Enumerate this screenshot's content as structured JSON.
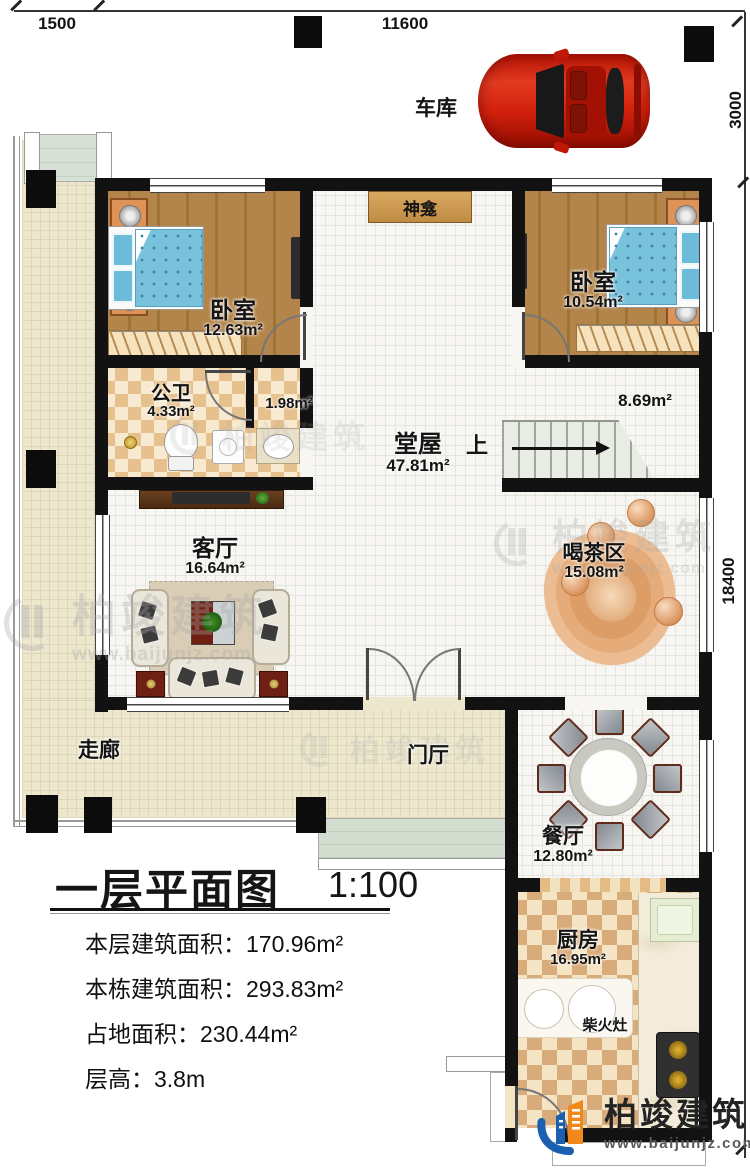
{
  "dimensions": {
    "left_top": "1500",
    "top": "11600",
    "right_upper": "3000",
    "right_side": "18400"
  },
  "rooms": {
    "garage": {
      "label": "车库"
    },
    "shrine": {
      "label": "神龛"
    },
    "bedroom_left": {
      "label": "卧室",
      "area": "12.63m²"
    },
    "bedroom_right": {
      "label": "卧室",
      "area": "10.54m²"
    },
    "bathroom": {
      "label": "公卫",
      "area": "4.33m²"
    },
    "washroom": {
      "area": "1.98m²"
    },
    "hall": {
      "label": "堂屋",
      "area": "47.81m²"
    },
    "stairs": {
      "up": "上",
      "area": "8.69m²"
    },
    "living": {
      "label": "客厅",
      "area": "16.64m²"
    },
    "tea": {
      "label": "喝茶区",
      "area": "15.08m²"
    },
    "corridor": {
      "label": "走廊"
    },
    "foyer": {
      "label": "门厅"
    },
    "dining": {
      "label": "餐厅",
      "area": "12.80m²"
    },
    "kitchen": {
      "label": "厨房",
      "area": "16.95m²"
    },
    "wood_stove": {
      "label": "柴火灶"
    }
  },
  "legend": {
    "title": "一层平面图",
    "scale": "1:100",
    "rows": [
      "本层建筑面积：170.96m²",
      "本栋建筑面积：293.83m²",
      "占地面积：230.44m²",
      "层高：3.8m"
    ]
  },
  "brand": {
    "name": "柏竣建筑",
    "site": "www.baijunjz.com"
  },
  "colors": {
    "wall": "#121212",
    "brand_blue": "#1a5fb0",
    "brand_orange": "#f2881c",
    "bed_blue": "#79c2dc",
    "wood_floor": "#b08040",
    "checker_tan": "#e6c18d"
  }
}
